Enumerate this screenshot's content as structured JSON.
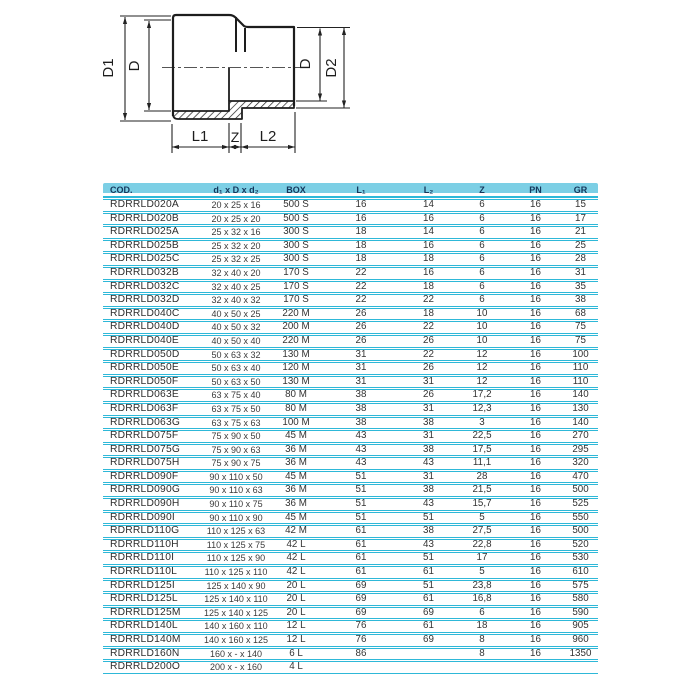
{
  "diagram": {
    "labels": {
      "d1_left": "D1",
      "d_left": "D",
      "d_right": "D",
      "d2_right": "D2",
      "l1": "L1",
      "z": "Z",
      "l2": "L2"
    }
  },
  "colors": {
    "accent_cyan": "#2eb8d8",
    "header_bg": "#7ccfe5",
    "header_text": "#14375c",
    "line_black": "#1d1d1d"
  },
  "table": {
    "column_keys": [
      "cod",
      "dim",
      "box",
      "l1",
      "l2",
      "z",
      "pn",
      "gr"
    ],
    "columns": [
      {
        "label": "COD."
      },
      {
        "label": "d₁ x D x d₂"
      },
      {
        "label": "BOX"
      },
      {
        "label": "L₁"
      },
      {
        "label": "L₂"
      },
      {
        "label": "Z"
      },
      {
        "label": "PN"
      },
      {
        "label": "GR"
      }
    ],
    "rows": [
      [
        "RDRRLD020A",
        "20 x 25 x 16",
        "500 S",
        "16",
        "14",
        "6",
        "16",
        "15"
      ],
      [
        "RDRRLD020B",
        "20 x 25 x 20",
        "500 S",
        "16",
        "16",
        "6",
        "16",
        "17"
      ],
      [
        "RDRRLD025A",
        "25 x 32 x 16",
        "300 S",
        "18",
        "14",
        "6",
        "16",
        "21"
      ],
      [
        "RDRRLD025B",
        "25 x 32 x 20",
        "300 S",
        "18",
        "16",
        "6",
        "16",
        "25"
      ],
      [
        "RDRRLD025C",
        "25 x 32 x 25",
        "300 S",
        "18",
        "18",
        "6",
        "16",
        "28"
      ],
      [
        "RDRRLD032B",
        "32 x 40 x 20",
        "170 S",
        "22",
        "16",
        "6",
        "16",
        "31"
      ],
      [
        "RDRRLD032C",
        "32 x 40 x 25",
        "170 S",
        "22",
        "18",
        "6",
        "16",
        "35"
      ],
      [
        "RDRRLD032D",
        "32 x 40 x 32",
        "170 S",
        "22",
        "22",
        "6",
        "16",
        "38"
      ],
      [
        "RDRRLD040C",
        "40 x 50 x 25",
        "220 M",
        "26",
        "18",
        "10",
        "16",
        "68"
      ],
      [
        "RDRRLD040D",
        "40 x 50 x 32",
        "200 M",
        "26",
        "22",
        "10",
        "16",
        "75"
      ],
      [
        "RDRRLD040E",
        "40 x 50 x 40",
        "220 M",
        "26",
        "26",
        "10",
        "16",
        "75"
      ],
      [
        "RDRRLD050D",
        "50 x 63 x 32",
        "130 M",
        "31",
        "22",
        "12",
        "16",
        "100"
      ],
      [
        "RDRRLD050E",
        "50 x 63 x 40",
        "120 M",
        "31",
        "26",
        "12",
        "16",
        "110"
      ],
      [
        "RDRRLD050F",
        "50 x 63 x 50",
        "130 M",
        "31",
        "31",
        "12",
        "16",
        "110"
      ],
      [
        "RDRRLD063E",
        "63 x 75 x 40",
        "80 M",
        "38",
        "26",
        "17,2",
        "16",
        "140"
      ],
      [
        "RDRRLD063F",
        "63 x 75 x 50",
        "80 M",
        "38",
        "31",
        "12,3",
        "16",
        "130"
      ],
      [
        "RDRRLD063G",
        "63 x 75 x 63",
        "100 M",
        "38",
        "38",
        "3",
        "16",
        "140"
      ],
      [
        "RDRRLD075F",
        "75 x 90 x 50",
        "45 M",
        "43",
        "31",
        "22,5",
        "16",
        "270"
      ],
      [
        "RDRRLD075G",
        "75 x 90 x 63",
        "36 M",
        "43",
        "38",
        "17,5",
        "16",
        "295"
      ],
      [
        "RDRRLD075H",
        "75 x 90 x 75",
        "36 M",
        "43",
        "43",
        "11,1",
        "16",
        "320"
      ],
      [
        "RDRRLD090F",
        "90 x 110 x 50",
        "45 M",
        "51",
        "31",
        "28",
        "16",
        "470"
      ],
      [
        "RDRRLD090G",
        "90 x 110 x 63",
        "36 M",
        "51",
        "38",
        "21,5",
        "16",
        "500"
      ],
      [
        "RDRRLD090H",
        "90 x 110 x 75",
        "36 M",
        "51",
        "43",
        "15,7",
        "16",
        "525"
      ],
      [
        "RDRRLD090I",
        "90 x 110 x 90",
        "45 M",
        "51",
        "51",
        "5",
        "16",
        "550"
      ],
      [
        "RDRRLD110G",
        "110 x 125 x 63",
        "42 M",
        "61",
        "38",
        "27,5",
        "16",
        "500"
      ],
      [
        "RDRRLD110H",
        "110 x 125 x 75",
        "42 L",
        "61",
        "43",
        "22,8",
        "16",
        "520"
      ],
      [
        "RDRRLD110I",
        "110 x 125 x 90",
        "42 L",
        "61",
        "51",
        "17",
        "16",
        "530"
      ],
      [
        "RDRRLD110L",
        "110 x 125 x 110",
        "42 L",
        "61",
        "61",
        "5",
        "16",
        "610"
      ],
      [
        "RDRRLD125I",
        "125 x 140 x 90",
        "20 L",
        "69",
        "51",
        "23,8",
        "16",
        "575"
      ],
      [
        "RDRRLD125L",
        "125 x 140 x 110",
        "20 L",
        "69",
        "61",
        "16,8",
        "16",
        "580"
      ],
      [
        "RDRRLD125M",
        "125 x 140 x 125",
        "20 L",
        "69",
        "69",
        "6",
        "16",
        "590"
      ],
      [
        "RDRRLD140L",
        "140 x 160 x 110",
        "12 L",
        "76",
        "61",
        "18",
        "16",
        "905"
      ],
      [
        "RDRRLD140M",
        "140 x 160 x 125",
        "12 L",
        "76",
        "69",
        "8",
        "16",
        "960"
      ],
      [
        "RDRRLD160N",
        "160 x - x 140",
        "6 L",
        "86",
        "",
        "8",
        "16",
        "1350"
      ],
      [
        "RDRRLD200O",
        "200 x - x 160",
        "4 L",
        "",
        "",
        "",
        "",
        ""
      ]
    ]
  }
}
